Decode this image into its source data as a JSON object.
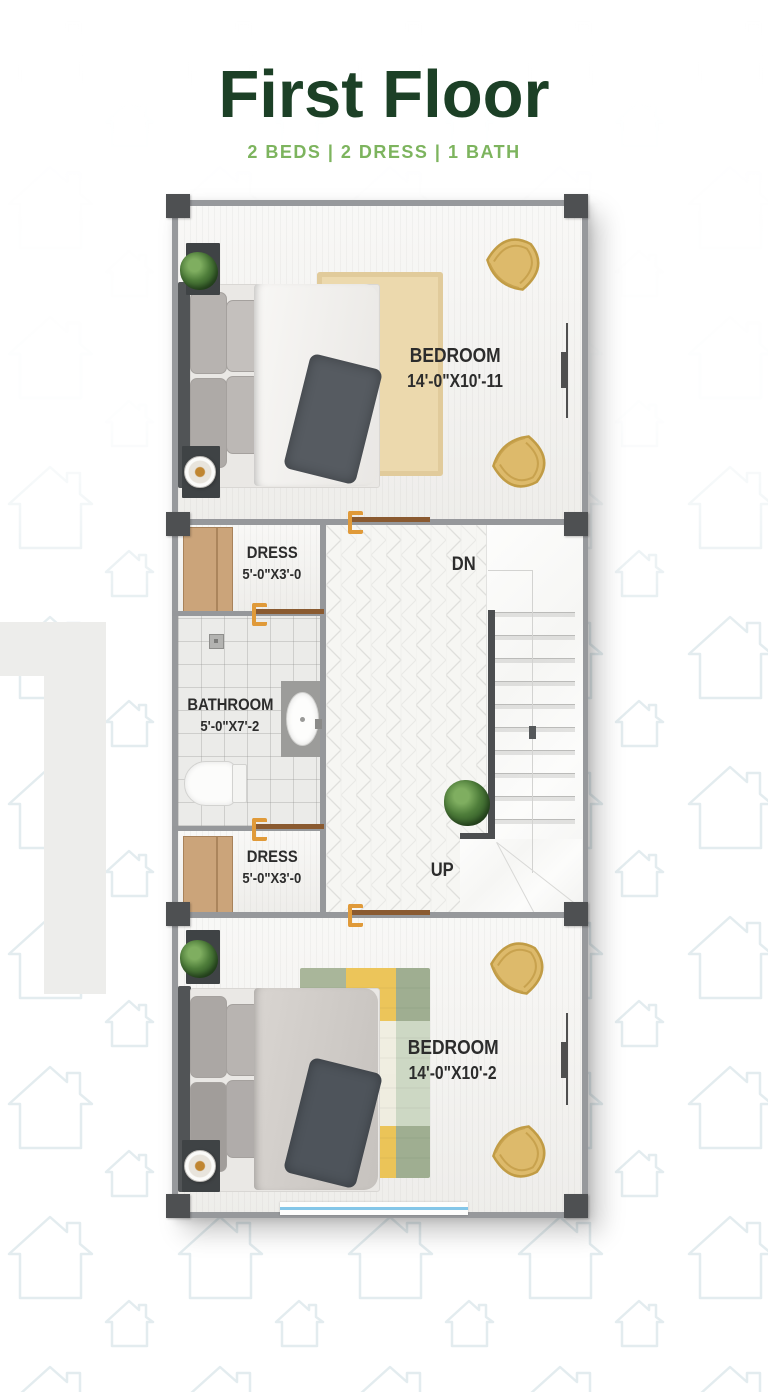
{
  "header": {
    "title": "First Floor",
    "subtitle": "2 BEDS | 2 DRESS | 1 BATH"
  },
  "floorplan": {
    "bedroom_top": {
      "name": "BEDROOM",
      "size": "14'-0\"X10'-11"
    },
    "dress_top": {
      "name": "DRESS",
      "size": "5'-0\"X3'-0"
    },
    "bathroom": {
      "name": "BATHROOM",
      "size": "5'-0\"X7'-2"
    },
    "dress_bottom": {
      "name": "DRESS",
      "size": "5'-0\"X3'-0"
    },
    "bedroom_bottom": {
      "name": "BEDROOM",
      "size": "14'-0\"X10'-2"
    },
    "stairs": {
      "down": "DN",
      "up": "UP"
    }
  },
  "colors": {
    "title_green": "#1c4026",
    "subtitle_green": "#7db45e",
    "wall_gray": "#96989b",
    "column_gray": "#4e5052",
    "door_leaf_brown": "#8a5a30",
    "door_accent_orange": "#e09a39",
    "closet_wood": "#cba47a",
    "chair_tan": "#ddba6b",
    "rug_beige": "#ecd9ad",
    "window_blue": "#84c6e8"
  }
}
